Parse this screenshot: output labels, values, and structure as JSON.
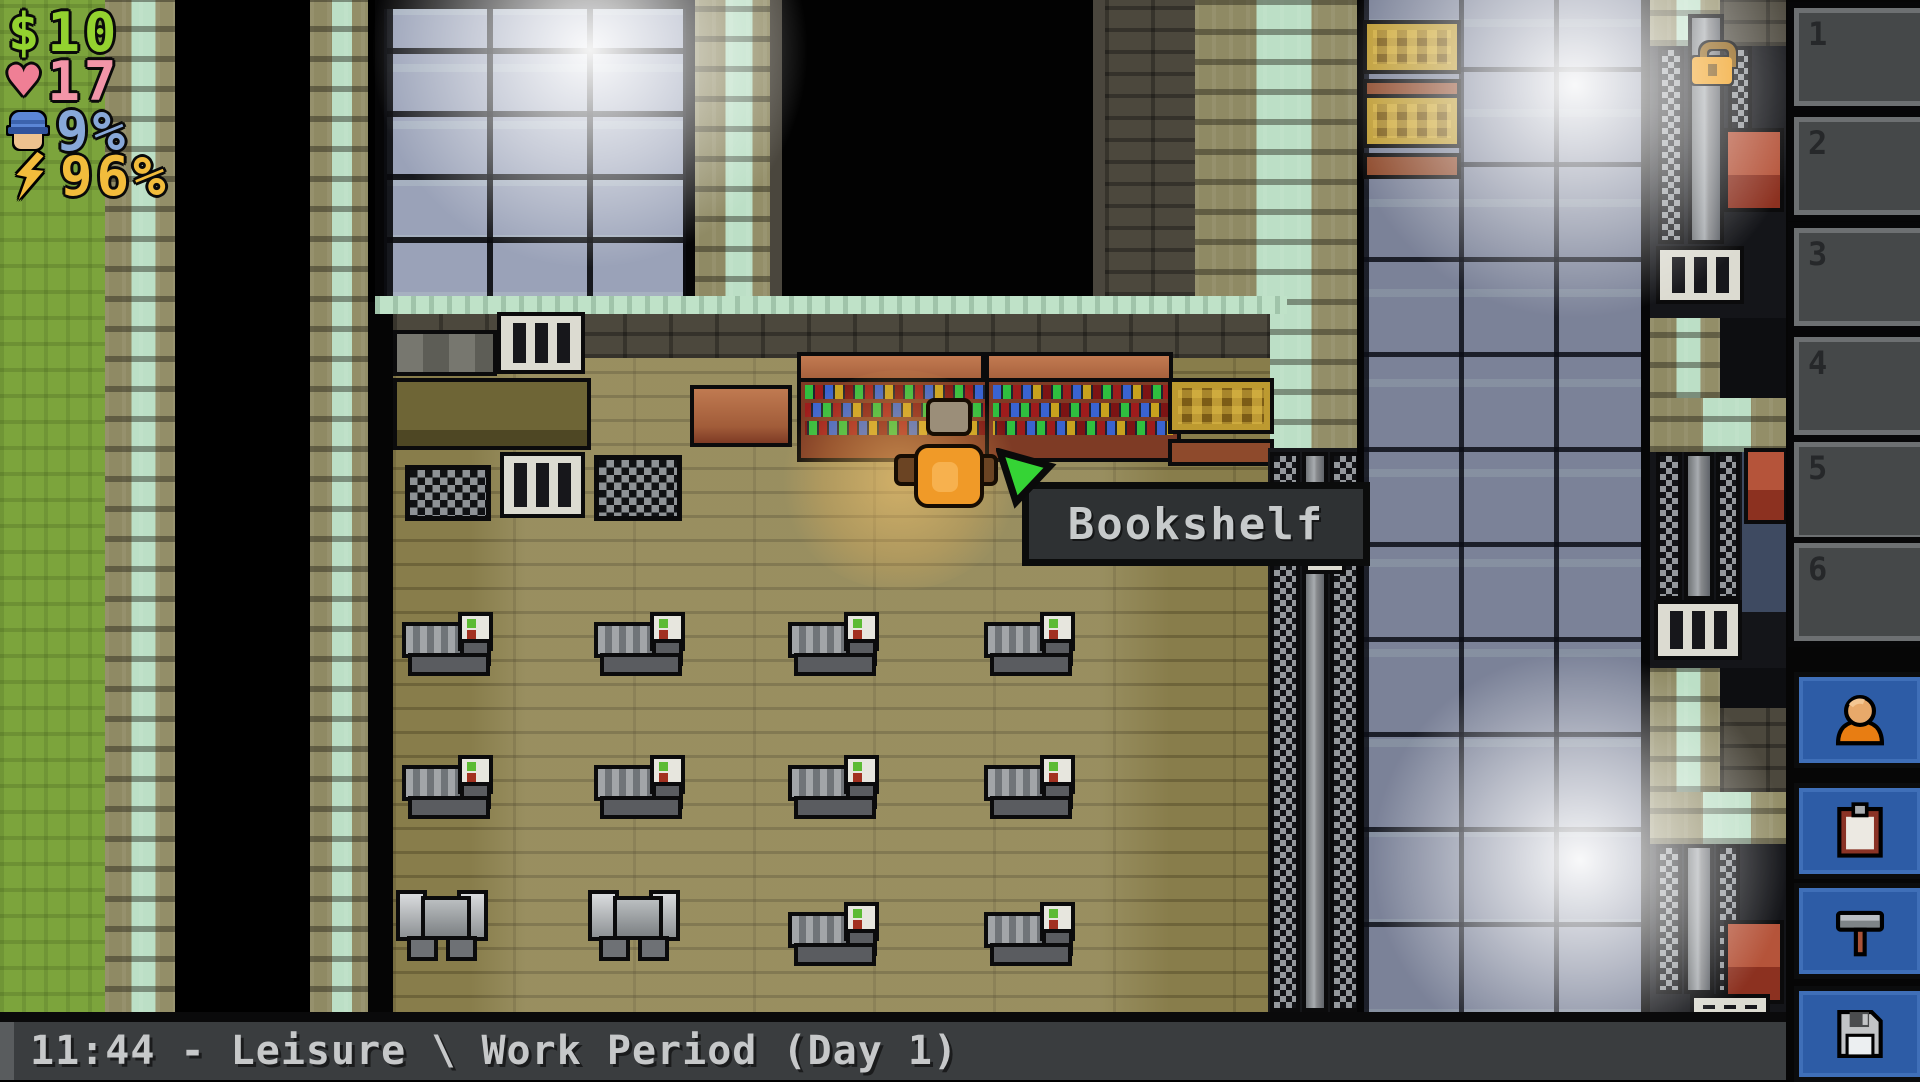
{
  "hud": {
    "money": {
      "icon": "dollar-icon",
      "value": "10"
    },
    "health": {
      "icon": "heart-icon",
      "value": "17"
    },
    "guard_heat": {
      "icon": "guard-icon",
      "value": "9%"
    },
    "energy": {
      "icon": "bolt-icon",
      "value": "96%"
    }
  },
  "tooltip": {
    "label": "Bookshelf",
    "cursor_icon": "cursor-arrow-icon"
  },
  "status_bar": {
    "text": "11:44 - Leisure \\ Work Period (Day 1)"
  },
  "sidebar": {
    "slots": [
      {
        "number": "1"
      },
      {
        "number": "2"
      },
      {
        "number": "3"
      },
      {
        "number": "4"
      },
      {
        "number": "5"
      },
      {
        "number": "6"
      }
    ],
    "buttons": [
      {
        "name": "character",
        "icon": "prisoner-icon"
      },
      {
        "name": "journal",
        "icon": "clipboard-icon"
      },
      {
        "name": "craft",
        "icon": "hammer-icon"
      },
      {
        "name": "save",
        "icon": "floppy-icon"
      }
    ]
  },
  "map": {
    "hovered_object": "Bookshelf",
    "padlock_icon": "padlock-icon"
  },
  "colors": {
    "hud_money": "#93d22f",
    "hud_health": "#ef8ba0",
    "hud_guard": "#88a8d8",
    "hud_energy": "#f2bc3c",
    "button_blue": "#2d5ca6",
    "tooltip_bg": "#2e3133",
    "status_bar_bg": "#3a3d3f",
    "cursor_green": "#35d435"
  }
}
